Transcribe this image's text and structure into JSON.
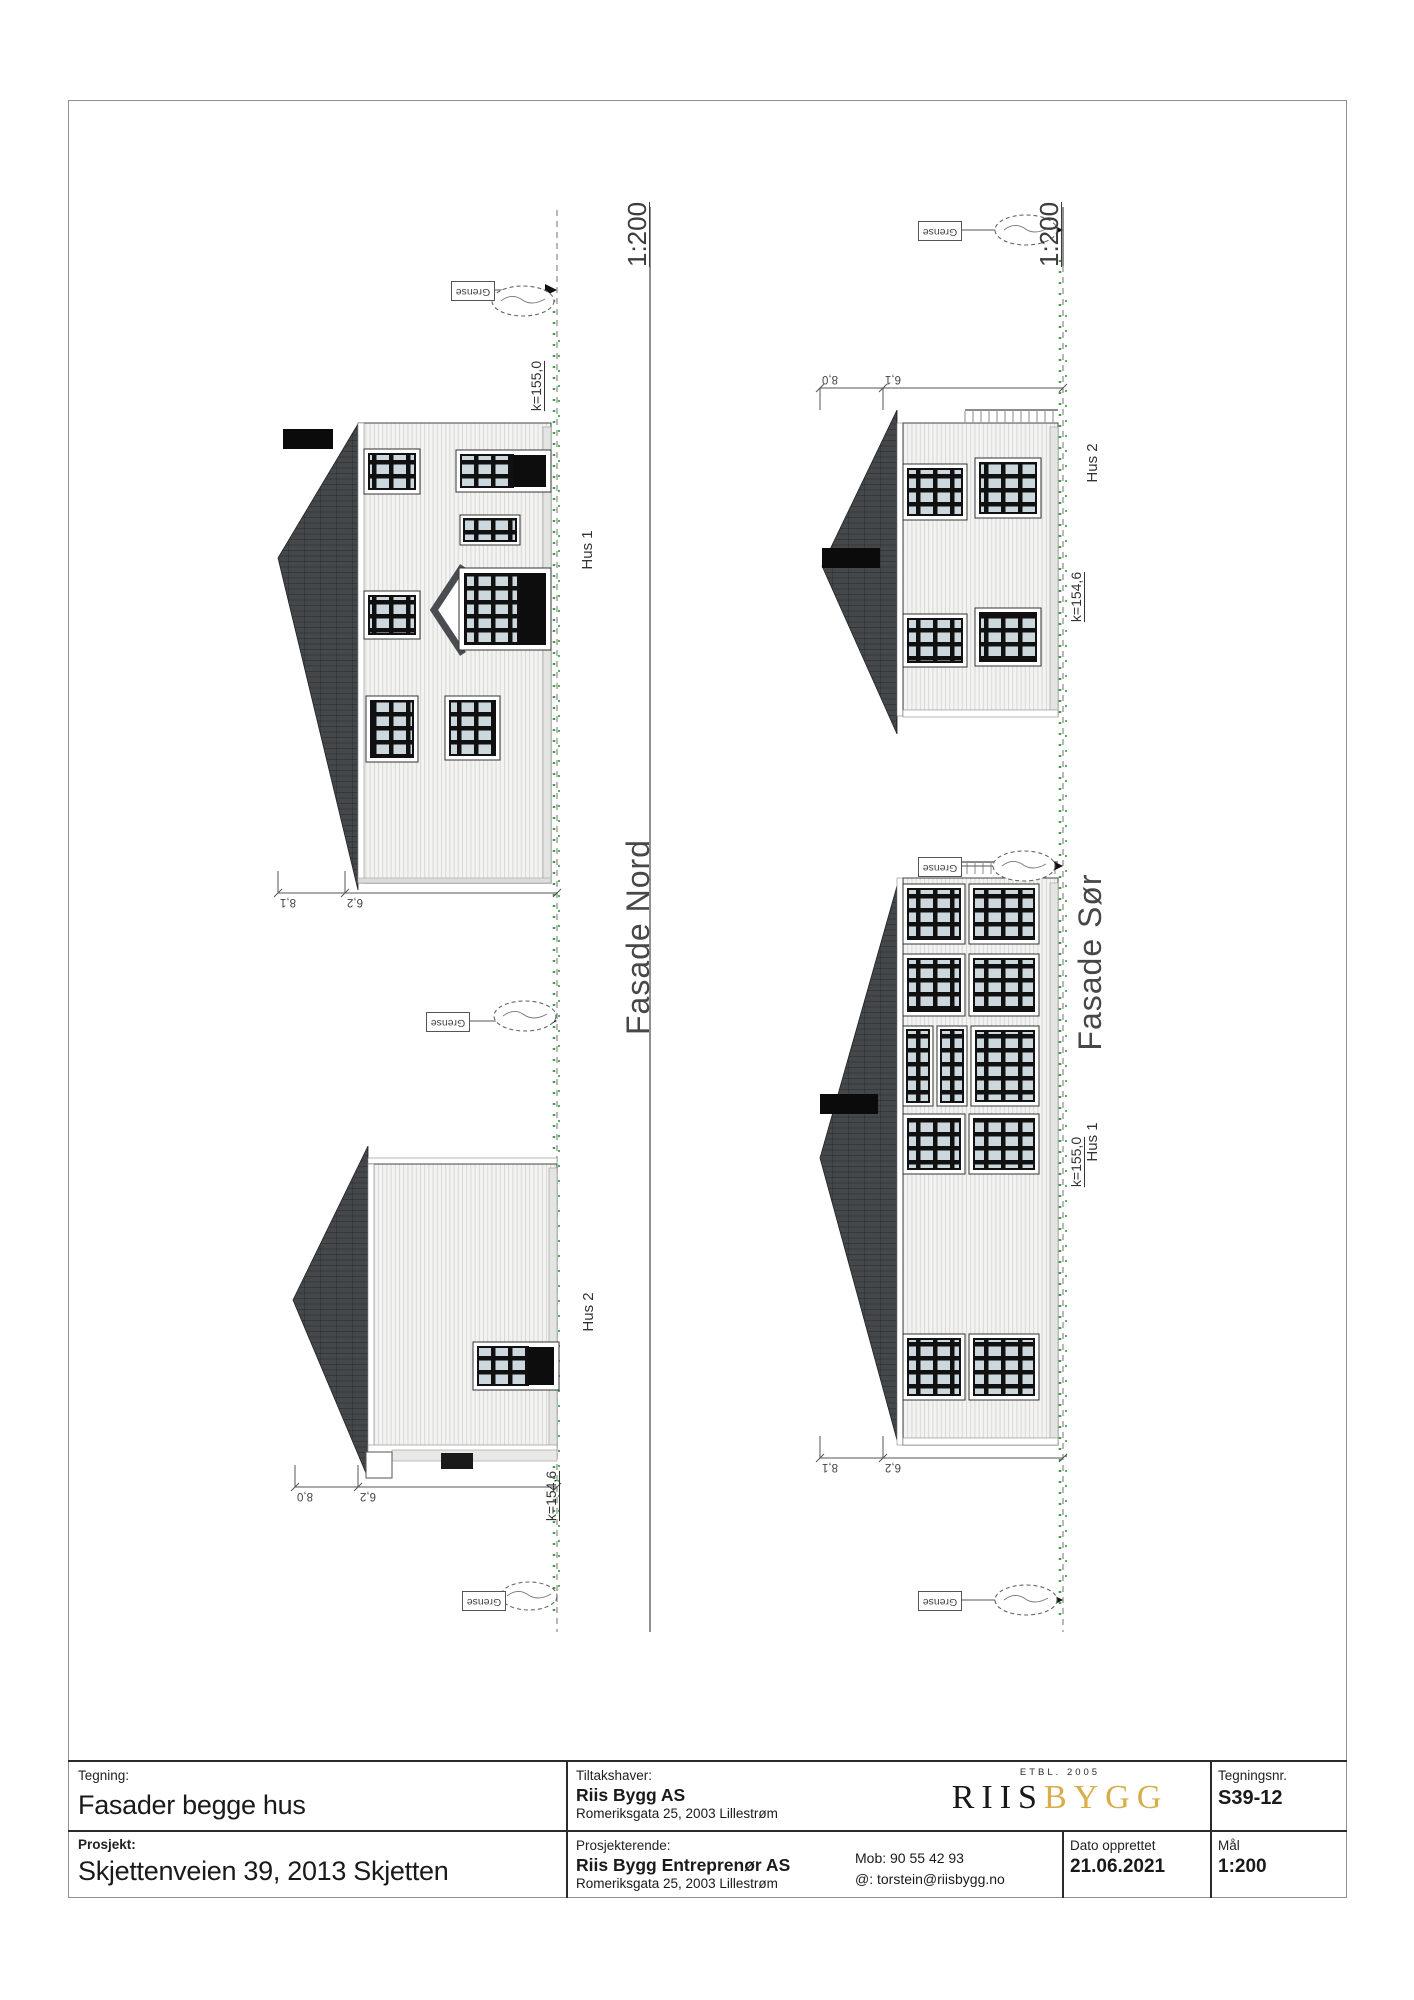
{
  "drawing": {
    "boundary_label": "Grense",
    "panels": [
      {
        "id": "nord",
        "title": "Fasade Nord",
        "scale": "1:200",
        "houses": [
          {
            "label": "Hus 1",
            "kote": "k=155,0",
            "dim_ridge": "8,1",
            "dim_eaves": "6,2"
          },
          {
            "label": "Hus 2",
            "kote": "k=154,6",
            "dim_ridge": "8,0",
            "dim_eaves": "6,2"
          }
        ]
      },
      {
        "id": "sor",
        "title": "Fasade Sør",
        "scale": "1:200",
        "houses": [
          {
            "label": "Hus 2",
            "kote": "k=154,6",
            "dim_ridge": "8,0",
            "dim_eaves": "6,1"
          },
          {
            "label": "Hus 1",
            "kote": "k=155,0",
            "dim_ridge": "8,1",
            "dim_eaves": "6,2"
          }
        ]
      }
    ]
  },
  "title_block": {
    "tegning_label": "Tegning:",
    "tegning": "Fasader begge hus",
    "prosjekt_label": "Prosjekt:",
    "prosjekt": "Skjettenveien 39, 2013 Skjetten",
    "tiltakshaver_label": "Tiltakshaver:",
    "tiltakshaver": "Riis Bygg AS",
    "tiltakshaver_adresse": "Romeriksgata 25, 2003 Lillestrøm",
    "prosjekterende_label": "Prosjekterende:",
    "prosjekterende": "Riis Bygg Entreprenør AS",
    "prosjekterende_adresse": "Romeriksgata 25, 2003 Lillestrøm",
    "mob": "Mob: 90 55 42 93",
    "epost": "@: torstein@riisbygg.no",
    "logo": {
      "etbl": "ETBL. 2005",
      "riis": "RIIS",
      "bygg": "BYGG"
    },
    "tegningsnr_label": "Tegningsnr.",
    "tegningsnr": "S39-12",
    "dato_label": "Dato opprettet",
    "dato": "21.06.2021",
    "maal_label": "Mål",
    "maal": "1:200"
  },
  "colors": {
    "logo_gold": "#d6ae4a",
    "terrain_green": "#3f9e42",
    "roof_dark": "#45484b"
  }
}
